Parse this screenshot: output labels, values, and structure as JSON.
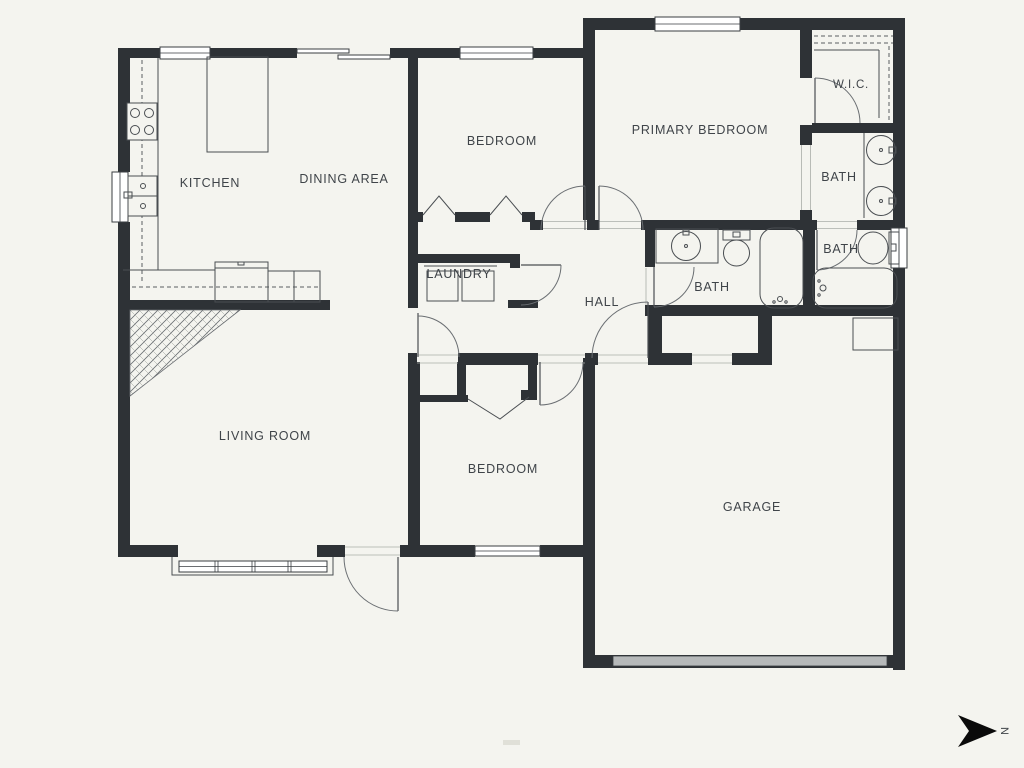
{
  "plan": {
    "background_color": "#f4f4ef",
    "wall_color": "#2e3236",
    "garage_door_color": "#b6b9ba",
    "rooms": {
      "kitchen": {
        "label": "KITCHEN"
      },
      "dining": {
        "label": "DINING AREA"
      },
      "bedroom_top": {
        "label": "BEDROOM"
      },
      "primary_bedroom": {
        "label": "PRIMARY BEDROOM"
      },
      "wic": {
        "label": "W.I.C."
      },
      "primary_bath": {
        "label": "BATH"
      },
      "upper_bath": {
        "label": "BATH"
      },
      "hall_bath": {
        "label": "BATH"
      },
      "laundry": {
        "label": "LAUNDRY"
      },
      "hall": {
        "label": "HALL"
      },
      "living_room": {
        "label": "LIVING ROOM"
      },
      "bedroom_bottom": {
        "label": "BEDROOM"
      },
      "garage": {
        "label": "GARAGE"
      }
    },
    "compass": {
      "label": "N"
    }
  }
}
